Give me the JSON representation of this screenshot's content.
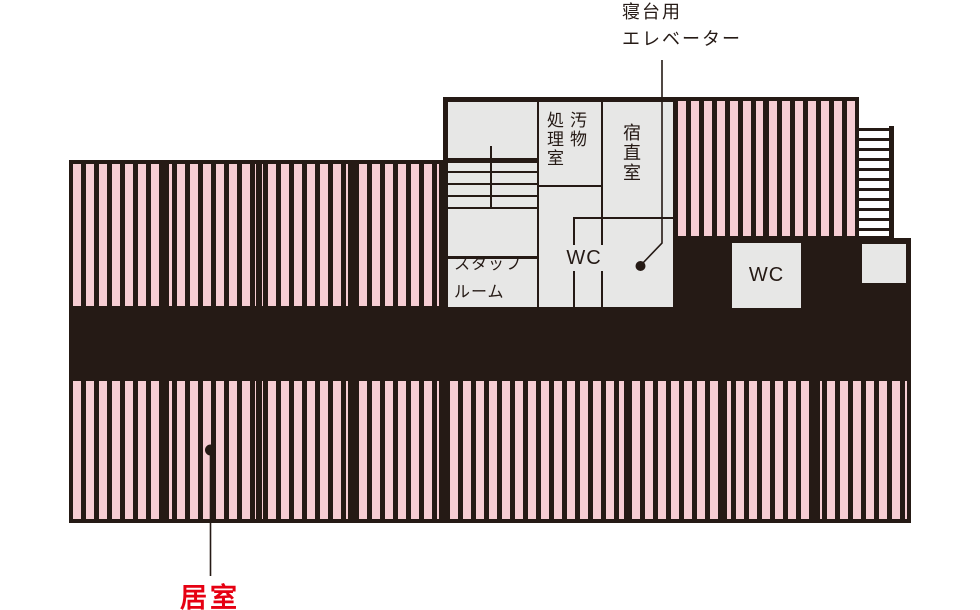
{
  "colors": {
    "ink": "#251a15",
    "stripe_pink": "#f6cdd3",
    "room_gray": "#e7e7e6",
    "callout_red": "#e60012",
    "paper": "#ffffff"
  },
  "callouts": {
    "bed_elevator": {
      "line1": "寝台用",
      "line2": "エレベーター"
    },
    "living_room": {
      "label": "居室"
    }
  },
  "rooms": {
    "waste_processing": {
      "line1": "汚物",
      "line2": "処理室"
    },
    "night_duty": {
      "label": "宿直室"
    },
    "staff": {
      "line1": "スタッフ",
      "line2": "ルーム"
    },
    "wc_inner": {
      "label": "WC"
    },
    "wc_outer": {
      "label": "WC"
    }
  }
}
